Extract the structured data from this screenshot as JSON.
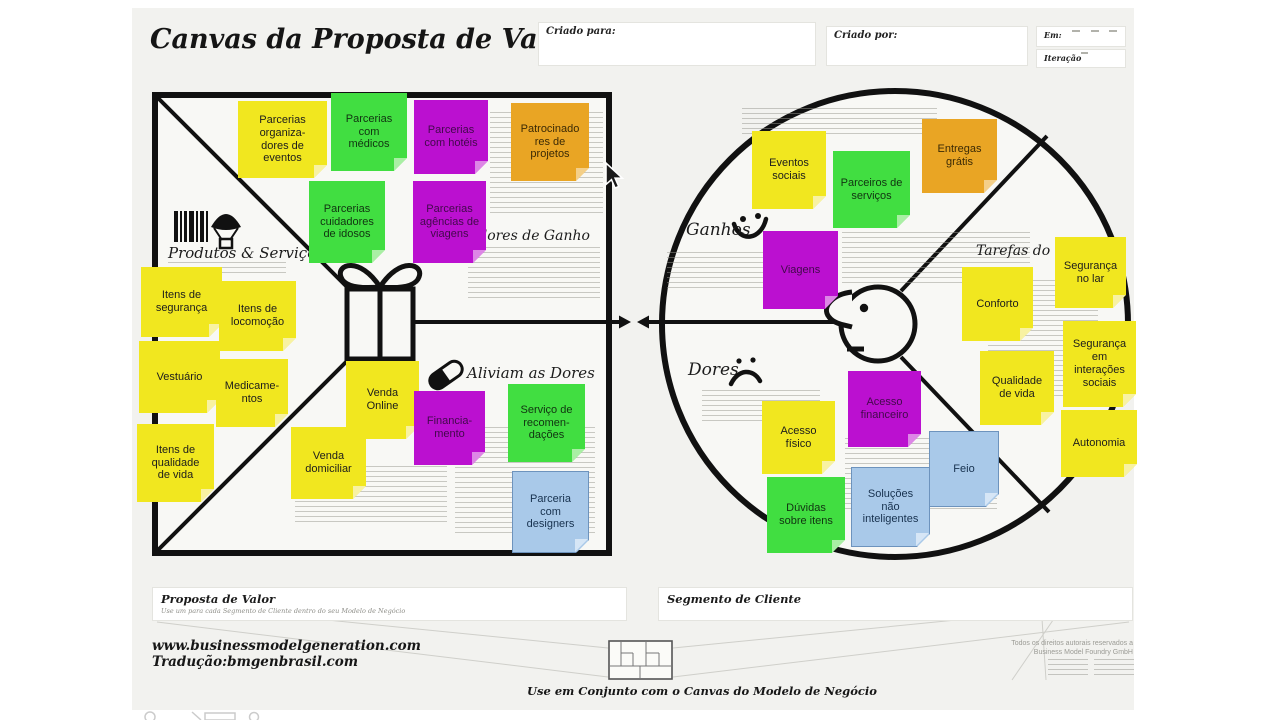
{
  "title": "Canvas da Proposta de Valor",
  "header": {
    "created_for": {
      "label": "Criado para:",
      "value": ""
    },
    "created_by": {
      "label": "Criado por:",
      "value": ""
    },
    "date": {
      "label": "Em:",
      "value": ""
    },
    "iteration": {
      "label": "Iteração",
      "value": ""
    }
  },
  "value_map": {
    "products_services_label": "Produtos & Serviços",
    "gain_creators_label": "Criadores de Ganho",
    "pain_relievers_label": "Aliviam as Dores"
  },
  "customer_profile": {
    "gains_label": "Ganhos",
    "customer_jobs_label": "Tarefas do Cliente",
    "pains_label": "Dores"
  },
  "colors": {
    "sheet": "#f2f2ef",
    "line": "#111111",
    "note_palette": {
      "yellow": {
        "bg": "#f1e71f",
        "fold": "#f8f2a2",
        "text": "#1c1c1c"
      },
      "green": {
        "bg": "#41de41",
        "fold": "#a9efa4",
        "text": "#113311"
      },
      "magenta": {
        "bg": "#bb10d0",
        "fold": "#dd86e6",
        "text": "#42094b"
      },
      "orange": {
        "bg": "#e9a524",
        "fold": "#f4cf88",
        "text": "#3b2a05"
      },
      "blue": {
        "bg": "#a9c9e9",
        "fold": "#d6e6f6",
        "text": "#17314e",
        "border": "#6d93bd"
      }
    }
  },
  "notes": [
    {
      "area": "value_map",
      "color": "yellow",
      "text": "Parcerias\norganiza-\ndores de\neventos",
      "x": 238,
      "y": 101,
      "w": 89,
      "h": 77
    },
    {
      "area": "value_map",
      "color": "green",
      "text": "Parcerias\ncom\nmédicos",
      "x": 331,
      "y": 93,
      "w": 76,
      "h": 78
    },
    {
      "area": "value_map",
      "color": "magenta",
      "text": "Parcerias\ncom hotéis",
      "x": 414,
      "y": 100,
      "w": 74,
      "h": 74
    },
    {
      "area": "value_map",
      "color": "orange",
      "text": "Patrocinado\nres de\nprojetos",
      "x": 511,
      "y": 103,
      "w": 78,
      "h": 78
    },
    {
      "area": "value_map",
      "color": "green",
      "text": "Parcerias\ncuidadores\nde idosos",
      "x": 309,
      "y": 181,
      "w": 76,
      "h": 82
    },
    {
      "area": "value_map",
      "color": "magenta",
      "text": "Parcerias\nagências de\nviagens",
      "x": 413,
      "y": 181,
      "w": 73,
      "h": 82
    },
    {
      "area": "value_map",
      "color": "yellow",
      "text": "Itens de\nsegurança",
      "x": 141,
      "y": 267,
      "w": 81,
      "h": 70
    },
    {
      "area": "value_map",
      "color": "yellow",
      "text": "Itens de\nlocomoção",
      "x": 219,
      "y": 281,
      "w": 77,
      "h": 70
    },
    {
      "area": "value_map",
      "color": "yellow",
      "text": "Vestuário",
      "x": 139,
      "y": 341,
      "w": 81,
      "h": 72
    },
    {
      "area": "value_map",
      "color": "yellow",
      "text": "Medicame-\nntos",
      "x": 216,
      "y": 359,
      "w": 72,
      "h": 68
    },
    {
      "area": "value_map",
      "color": "yellow",
      "text": "Itens de\nqualidade\nde vida",
      "x": 137,
      "y": 424,
      "w": 77,
      "h": 78
    },
    {
      "area": "value_map",
      "color": "yellow",
      "text": "Venda\nOnline",
      "x": 346,
      "y": 361,
      "w": 73,
      "h": 78
    },
    {
      "area": "value_map",
      "color": "magenta",
      "text": "Financia-\nmento",
      "x": 414,
      "y": 391,
      "w": 71,
      "h": 74
    },
    {
      "area": "value_map",
      "color": "green",
      "text": "Serviço de\nrecomen-\ndações",
      "x": 508,
      "y": 384,
      "w": 77,
      "h": 78
    },
    {
      "area": "value_map",
      "color": "yellow",
      "text": "Venda\ndomiciliar",
      "x": 291,
      "y": 427,
      "w": 75,
      "h": 72
    },
    {
      "area": "value_map",
      "color": "blue",
      "text": "Parceria\ncom\ndesigners",
      "x": 512,
      "y": 471,
      "w": 77,
      "h": 82
    },
    {
      "area": "customer_profile",
      "color": "yellow",
      "text": "Eventos\nsociais",
      "x": 752,
      "y": 131,
      "w": 74,
      "h": 78
    },
    {
      "area": "customer_profile",
      "color": "green",
      "text": "Parceiros de\nserviços",
      "x": 833,
      "y": 151,
      "w": 77,
      "h": 77
    },
    {
      "area": "customer_profile",
      "color": "orange",
      "text": "Entregas\ngrátis",
      "x": 922,
      "y": 119,
      "w": 75,
      "h": 74
    },
    {
      "area": "customer_profile",
      "color": "magenta",
      "text": "Viagens",
      "x": 763,
      "y": 231,
      "w": 75,
      "h": 78
    },
    {
      "area": "customer_profile",
      "color": "yellow",
      "text": "Conforto",
      "x": 962,
      "y": 267,
      "w": 71,
      "h": 74
    },
    {
      "area": "customer_profile",
      "color": "yellow",
      "text": "Segurança\nno lar",
      "x": 1055,
      "y": 237,
      "w": 71,
      "h": 71
    },
    {
      "area": "customer_profile",
      "color": "yellow",
      "text": "Segurança\nem\ninterações\nsociais",
      "x": 1063,
      "y": 321,
      "w": 73,
      "h": 86
    },
    {
      "area": "customer_profile",
      "color": "yellow",
      "text": "Qualidade\nde vida",
      "x": 980,
      "y": 351,
      "w": 74,
      "h": 74
    },
    {
      "area": "customer_profile",
      "color": "yellow",
      "text": "Autonomia",
      "x": 1061,
      "y": 410,
      "w": 76,
      "h": 67
    },
    {
      "area": "customer_profile",
      "color": "yellow",
      "text": "Acesso\nfísico",
      "x": 762,
      "y": 401,
      "w": 73,
      "h": 73
    },
    {
      "area": "customer_profile",
      "color": "magenta",
      "text": "Acesso\nfinanceiro",
      "x": 848,
      "y": 371,
      "w": 73,
      "h": 76
    },
    {
      "area": "customer_profile",
      "color": "blue",
      "text": "Feio",
      "x": 929,
      "y": 431,
      "w": 70,
      "h": 76
    },
    {
      "area": "customer_profile",
      "color": "green",
      "text": "Dúvidas\nsobre itens",
      "x": 767,
      "y": 477,
      "w": 78,
      "h": 76
    },
    {
      "area": "customer_profile",
      "color": "blue",
      "text": "Soluções\nnão\ninteligentes",
      "x": 851,
      "y": 467,
      "w": 79,
      "h": 80
    }
  ],
  "footer": {
    "value_proposition_title": "Proposta de Valor",
    "value_proposition_subtitle": "Use um para cada Segmento de Cliente dentro do seu Modelo de Negócio",
    "customer_segment_title": "Segmento de Cliente",
    "website": "www.businessmodelgeneration.com",
    "translation": "Tradução:bmgenbrasil.com",
    "companion_note": "Use em Conjunto com o  Canvas do Modelo de Negócio",
    "copyright_line1": "Todos os direitos autorais reservados a",
    "copyright_line2": "Business Model Foundry GmbH"
  }
}
